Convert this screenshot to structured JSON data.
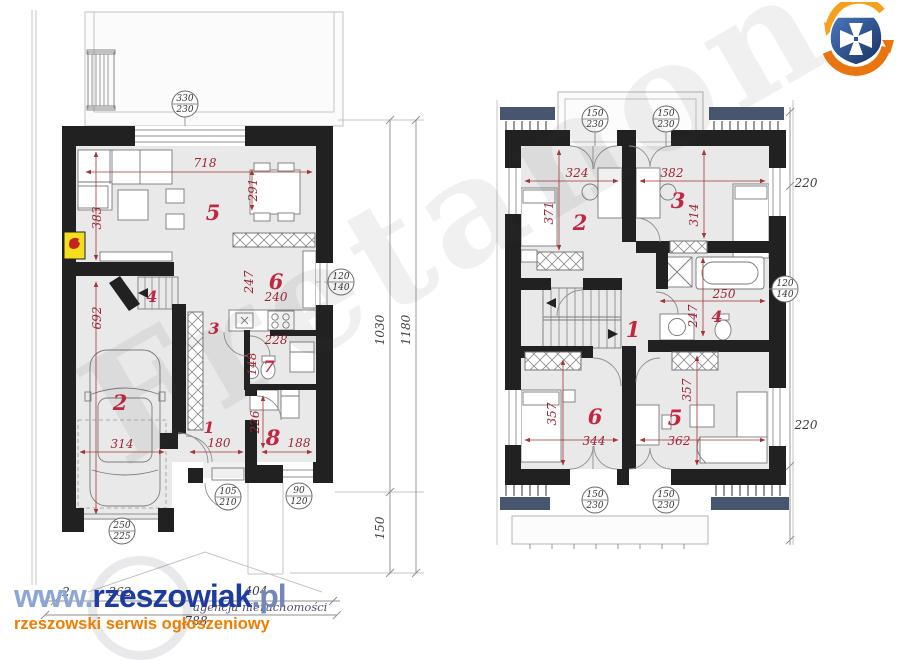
{
  "branding": {
    "www": "www.",
    "name": "rzeszowiak",
    "tld": ".pl",
    "tagline": "rzeszowski serwis ogłoszeniowy",
    "agency": "agencja nieruchomości"
  },
  "watermark": {
    "text": "Fretanon"
  },
  "colors": {
    "wall": "#212121",
    "room_fill": "#e9e9e9",
    "dimension_red": "#9c2433",
    "room_number_red": "#c22742",
    "roof_navy": "#47566f",
    "brand_blue": "#1e3c9f",
    "brand_orange": "#f07c00"
  },
  "gf": {
    "room_numbers": {
      "corridor": "1",
      "garage": "2",
      "hall": "3",
      "stairs": "4",
      "living": "5",
      "kitchen": "6",
      "wc": "7",
      "office": "8"
    },
    "dims": {
      "w718": "718",
      "w291": "291",
      "w383": "383",
      "w692": "692",
      "w314": "314",
      "w247": "247",
      "w240": "240",
      "w228": "228",
      "w148": "148",
      "w180": "180",
      "w226": "226",
      "w188": "188"
    },
    "totals": {
      "a": "2",
      "b": "362",
      "c": "404",
      "d": "788"
    },
    "vdims": {
      "v1030": "1030",
      "v1180": "1180",
      "v150": "150"
    },
    "circles": {
      "top": {
        "a": "330",
        "b": "230"
      },
      "kitchen": {
        "a": "120",
        "b": "140"
      },
      "entry": {
        "a": "105",
        "b": "210"
      },
      "office": {
        "a": "90",
        "b": "120"
      },
      "garage": {
        "a": "250",
        "b": "225"
      }
    }
  },
  "uf": {
    "room_numbers": {
      "hall": "1",
      "bed2": "2",
      "bed3": "3",
      "bath": "4",
      "bed5": "5",
      "bed6": "6"
    },
    "dims": {
      "w324": "324",
      "w382": "382",
      "w371": "371",
      "w314": "314",
      "w250": "250",
      "w247": "247",
      "w357l": "357",
      "w344": "344",
      "w362": "362",
      "w357r": "357"
    },
    "vdims": {
      "top": "220",
      "bottom": "220"
    },
    "circles": {
      "top1": {
        "a": "150",
        "b": "230"
      },
      "top2": {
        "a": "150",
        "b": "230"
      },
      "bot1": {
        "a": "150",
        "b": "230"
      },
      "bot2": {
        "a": "150",
        "b": "230"
      },
      "bath": {
        "a": "120",
        "b": "140"
      }
    }
  }
}
